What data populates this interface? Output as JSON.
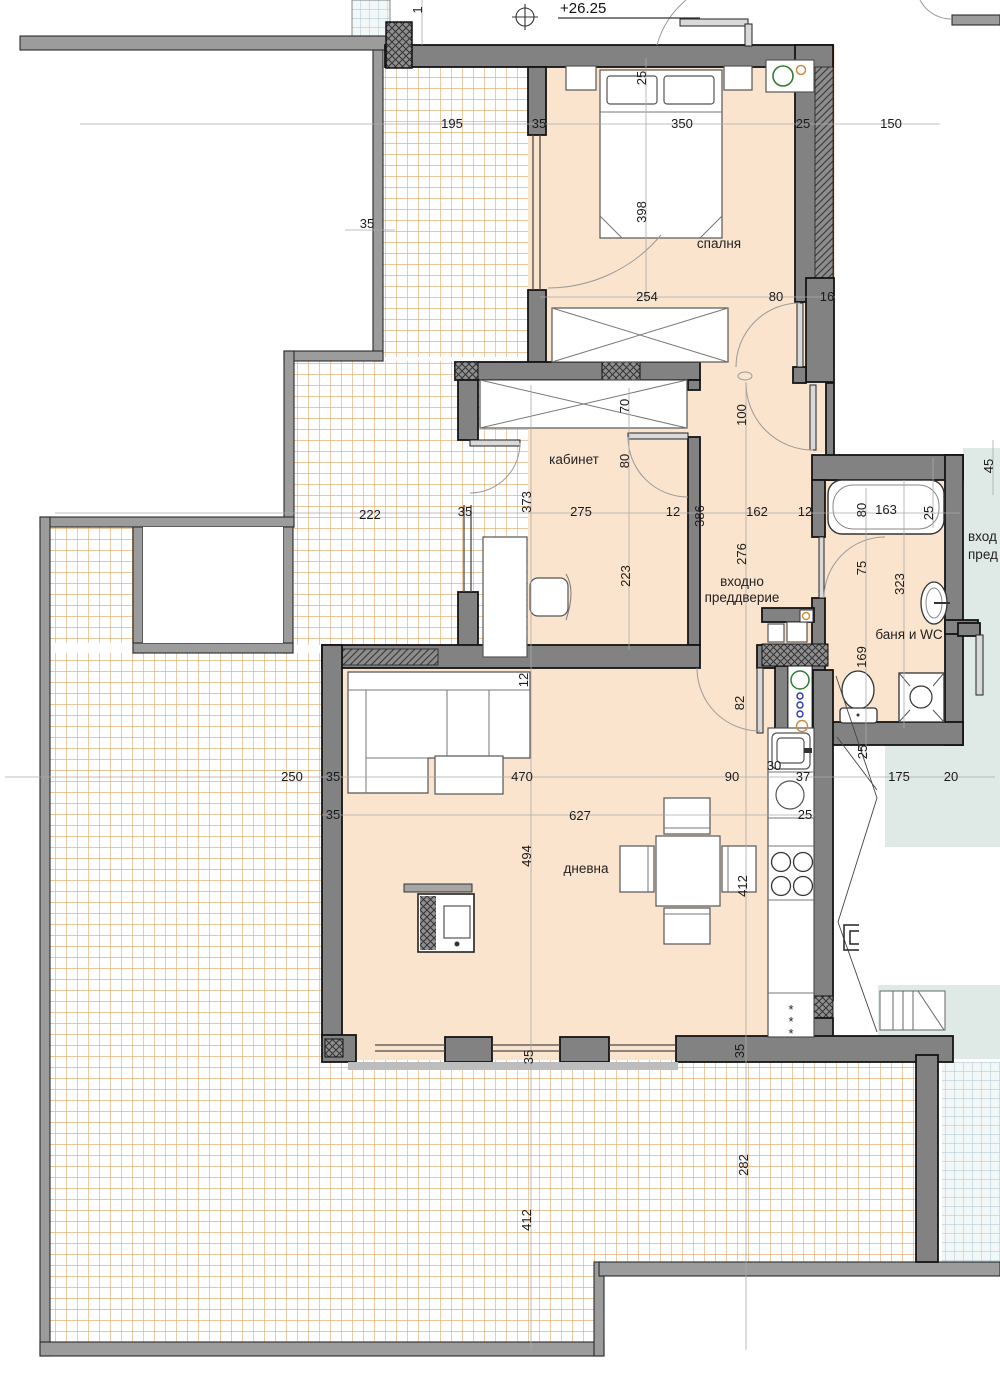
{
  "drawing": {
    "elevation_marker": "+26.25",
    "type_label": "floor-plan"
  },
  "colors": {
    "wall": "#828282",
    "wall_outline": "#141414",
    "floor": "#fbe4cd",
    "terrace_tile_line": "#e9b37e",
    "neighbor_floor": "#dfe9e5",
    "neighbor_tile_line": "#b5cdd8",
    "dim_text": "#1a1a1a"
  },
  "rooms": [
    {
      "id": "bedroom",
      "label": "спалня",
      "x": 719,
      "y": 248
    },
    {
      "id": "office",
      "label": "кабинет",
      "x": 574,
      "y": 464
    },
    {
      "id": "entry-hall",
      "lines": [
        "входно",
        "преддверие"
      ],
      "x": 742,
      "y": 586,
      "lh": 16
    },
    {
      "id": "bathroom",
      "label": "баня и WC",
      "x": 909,
      "y": 639
    },
    {
      "id": "living-room",
      "label": "дневна",
      "x": 586,
      "y": 873
    },
    {
      "id": "neighbor-entry-hall",
      "lines": [
        "вход",
        "пред"
      ],
      "x": 968,
      "y": 541,
      "lh": 18,
      "anchor": "start"
    }
  ],
  "dimensions": [
    {
      "v": "195",
      "x": 452,
      "y": 124,
      "r": 0
    },
    {
      "v": "35",
      "x": 539,
      "y": 124,
      "r": 0
    },
    {
      "v": "350",
      "x": 682,
      "y": 124,
      "r": 0
    },
    {
      "v": "25",
      "x": 803,
      "y": 124,
      "r": 0
    },
    {
      "v": "150",
      "x": 891,
      "y": 124,
      "r": 0
    },
    {
      "v": "254",
      "x": 647,
      "y": 297,
      "r": 0
    },
    {
      "v": "80",
      "x": 776,
      "y": 297,
      "r": 0
    },
    {
      "v": "16",
      "x": 827,
      "y": 297,
      "r": 0
    },
    {
      "v": "35",
      "x": 367,
      "y": 224,
      "r": 0
    },
    {
      "v": "222",
      "x": 370,
      "y": 515,
      "r": 0
    },
    {
      "v": "35",
      "x": 465,
      "y": 512,
      "r": 0
    },
    {
      "v": "275",
      "x": 581,
      "y": 512,
      "r": 0
    },
    {
      "v": "12",
      "x": 673,
      "y": 512,
      "r": 0
    },
    {
      "v": "162",
      "x": 757,
      "y": 512,
      "r": 0
    },
    {
      "v": "12",
      "x": 805,
      "y": 512,
      "r": 0
    },
    {
      "v": "163",
      "x": 886,
      "y": 510,
      "r": 0
    },
    {
      "v": "250",
      "x": 292,
      "y": 777,
      "r": 0
    },
    {
      "v": "35",
      "x": 333,
      "y": 777,
      "r": 0
    },
    {
      "v": "470",
      "x": 522,
      "y": 777,
      "r": 0
    },
    {
      "v": "90",
      "x": 732,
      "y": 777,
      "r": 0
    },
    {
      "v": "37",
      "x": 803,
      "y": 777,
      "r": 0
    },
    {
      "v": "30",
      "x": 774,
      "y": 766,
      "r": 0
    },
    {
      "v": "175",
      "x": 899,
      "y": 777,
      "r": 0
    },
    {
      "v": "20",
      "x": 951,
      "y": 777,
      "r": 0
    },
    {
      "v": "35",
      "x": 333,
      "y": 815,
      "r": 0
    },
    {
      "v": "627",
      "x": 580,
      "y": 816,
      "r": 0
    },
    {
      "v": "25",
      "x": 805,
      "y": 815,
      "r": 0
    },
    {
      "v": "1",
      "x": 422,
      "y": 10,
      "r": 1
    },
    {
      "v": "25",
      "x": 646,
      "y": 78,
      "r": 1
    },
    {
      "v": "398",
      "x": 646,
      "y": 212,
      "r": 1
    },
    {
      "v": "70",
      "x": 629,
      "y": 406,
      "r": 1
    },
    {
      "v": "80",
      "x": 629,
      "y": 461,
      "r": 1
    },
    {
      "v": "100",
      "x": 746,
      "y": 415,
      "r": 1
    },
    {
      "v": "373",
      "x": 531,
      "y": 502,
      "r": 1
    },
    {
      "v": "386",
      "x": 704,
      "y": 516,
      "r": 1
    },
    {
      "v": "80",
      "x": 866,
      "y": 510,
      "r": 1
    },
    {
      "v": "25",
      "x": 933,
      "y": 513,
      "r": 1
    },
    {
      "v": "45",
      "x": 993,
      "y": 466,
      "r": 1
    },
    {
      "v": "276",
      "x": 746,
      "y": 554,
      "r": 1
    },
    {
      "v": "223",
      "x": 630,
      "y": 576,
      "r": 1
    },
    {
      "v": "75",
      "x": 866,
      "y": 568,
      "r": 1
    },
    {
      "v": "323",
      "x": 904,
      "y": 584,
      "r": 1
    },
    {
      "v": "169",
      "x": 866,
      "y": 657,
      "r": 1
    },
    {
      "v": "12",
      "x": 528,
      "y": 680,
      "r": 1
    },
    {
      "v": "82",
      "x": 744,
      "y": 703,
      "r": 1
    },
    {
      "v": "25",
      "x": 867,
      "y": 752,
      "r": 1
    },
    {
      "v": "494",
      "x": 531,
      "y": 856,
      "r": 1
    },
    {
      "v": "412",
      "x": 747,
      "y": 886,
      "r": 1
    },
    {
      "v": "35",
      "x": 533,
      "y": 1057,
      "r": 1
    },
    {
      "v": "35",
      "x": 744,
      "y": 1051,
      "r": 1
    },
    {
      "v": "412",
      "x": 531,
      "y": 1220,
      "r": 1
    },
    {
      "v": "282",
      "x": 748,
      "y": 1165,
      "r": 1
    }
  ],
  "kitchen": {
    "stove_marks": [
      "*",
      "*",
      "*"
    ]
  }
}
